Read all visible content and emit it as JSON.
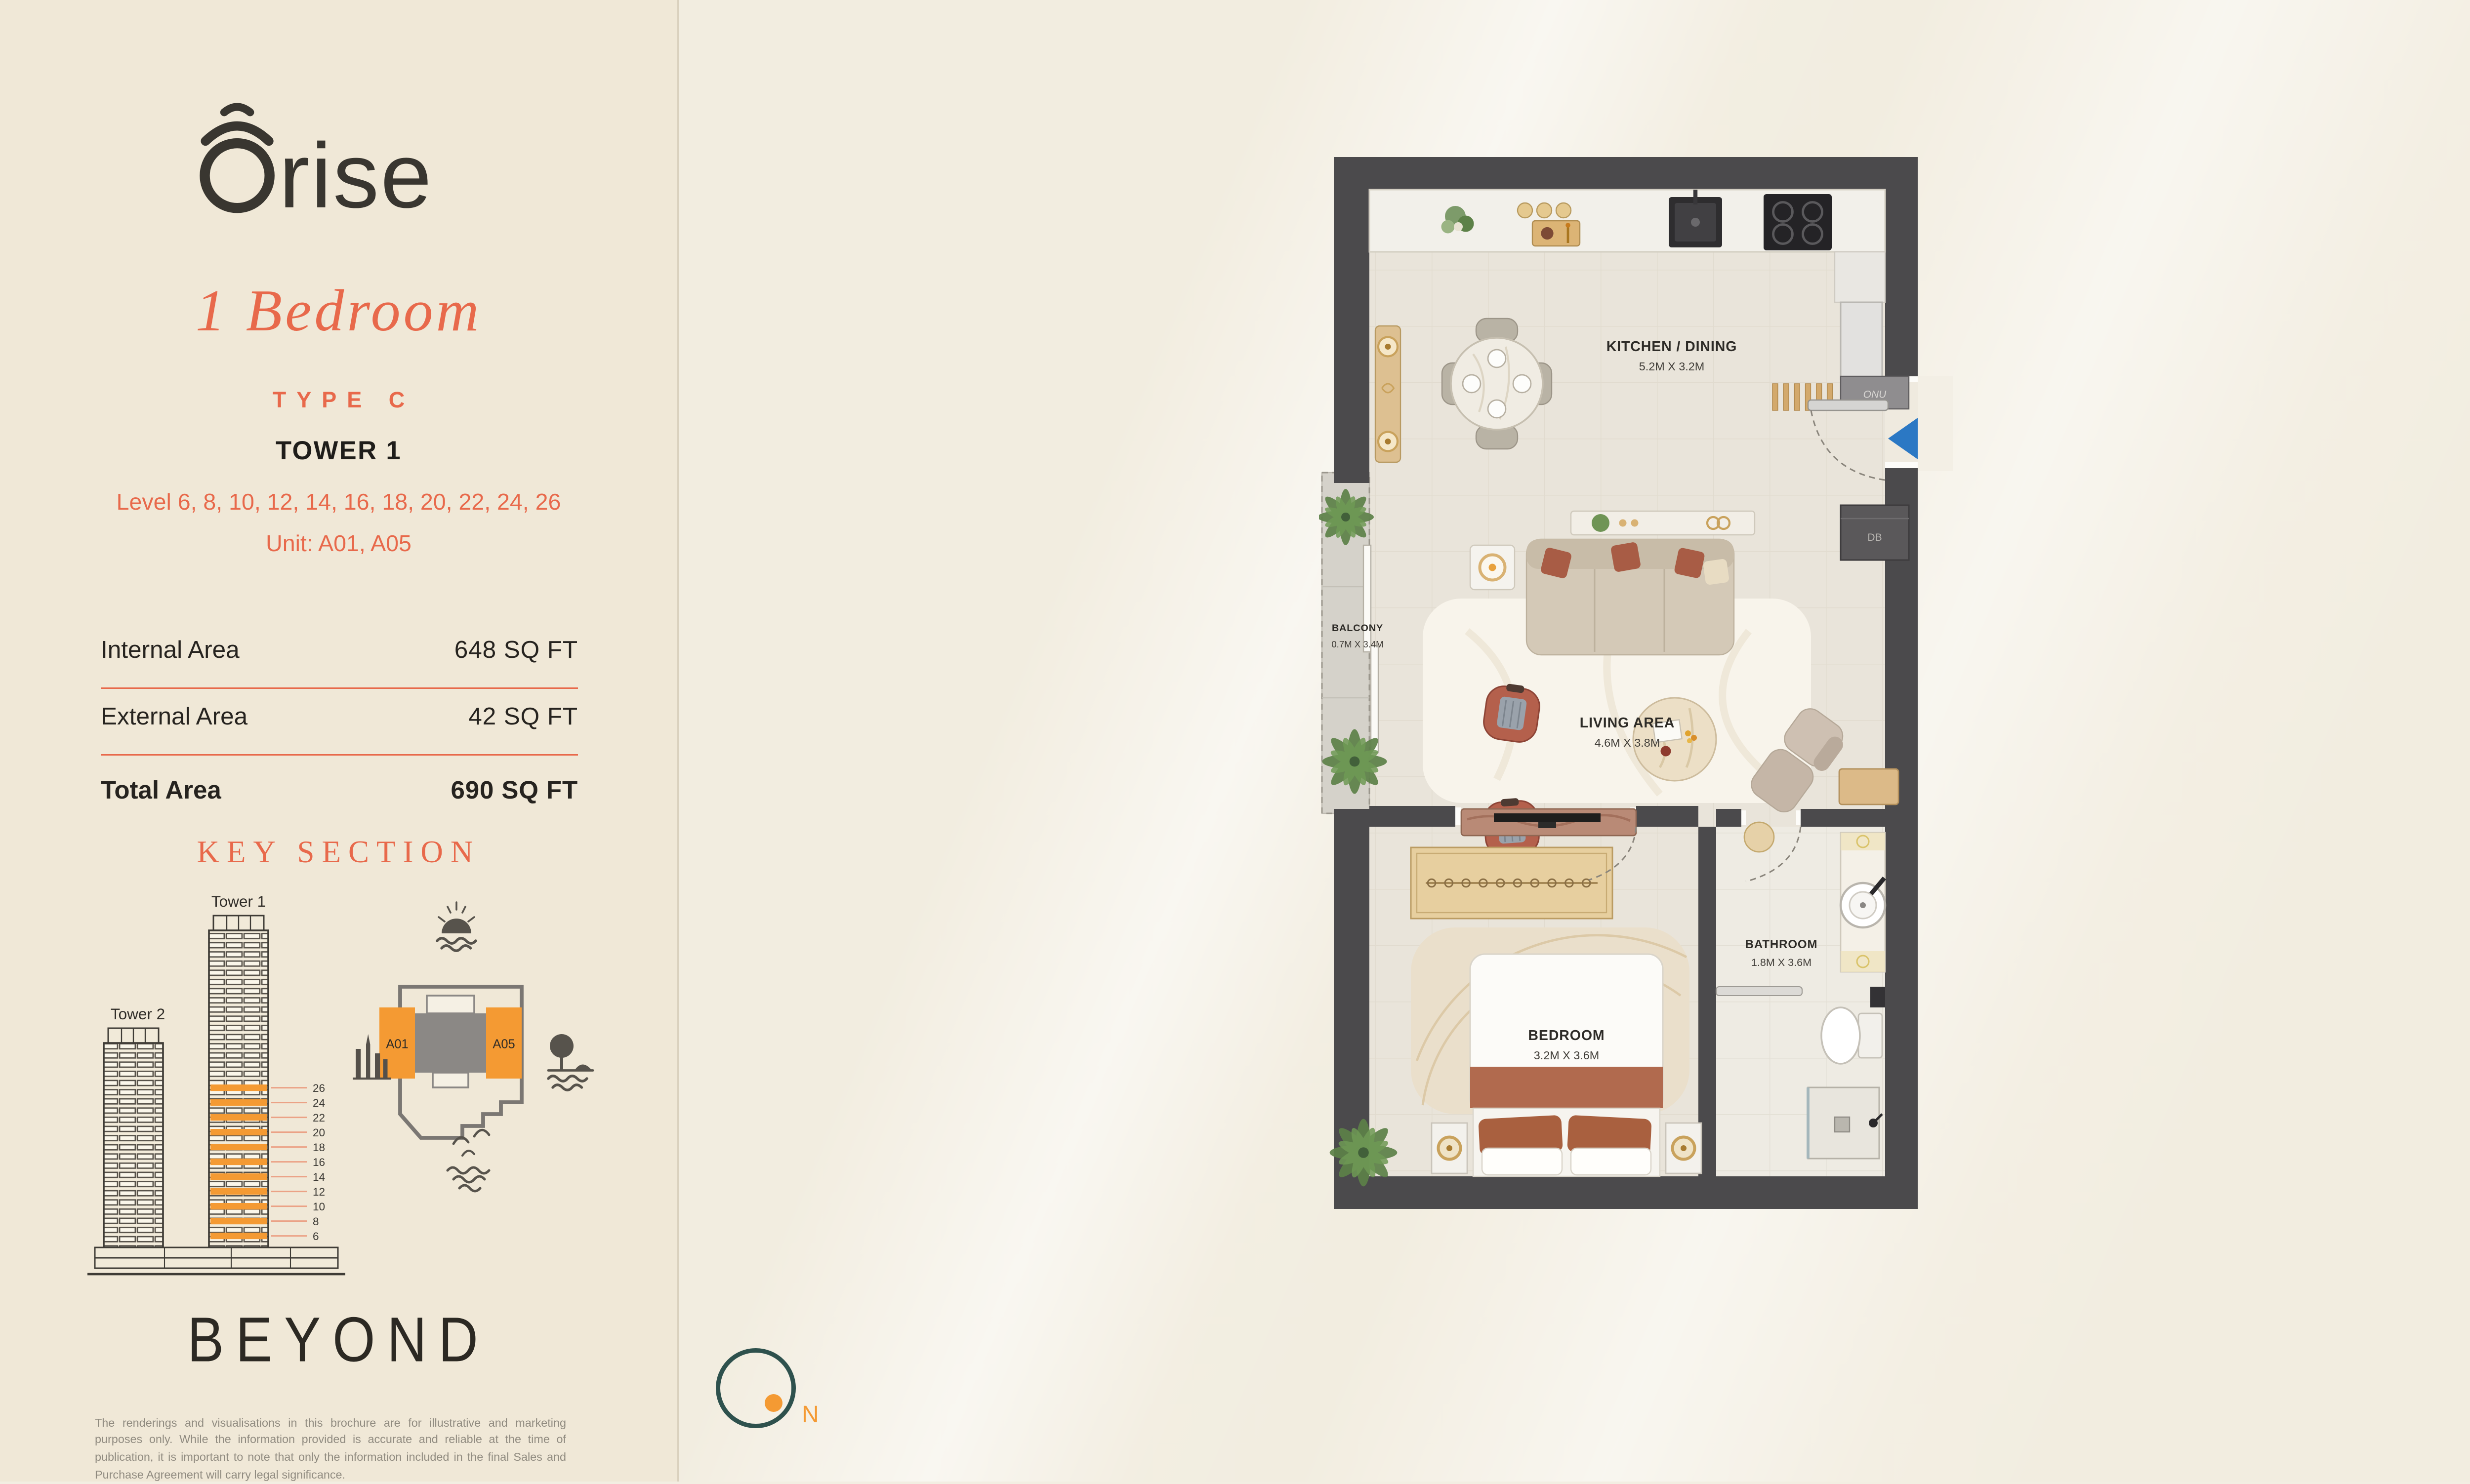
{
  "brand": {
    "logo_suffix": "rise",
    "developer_logo": "BEYOND"
  },
  "header": {
    "unit_title": "1 Bedroom",
    "unit_type": "TYPE C",
    "tower": "TOWER 1",
    "levels": "Level 6, 8, 10, 12, 14, 16, 18, 20, 22, 24, 26",
    "units": "Unit: A01, A05"
  },
  "areas": {
    "rows": [
      {
        "label": "Internal Area",
        "value": "648 SQ FT"
      },
      {
        "label": "External Area",
        "value": "42 SQ FT"
      }
    ],
    "total_label": "Total Area",
    "total_value": "690 SQ FT"
  },
  "key_section": {
    "title": "KEY SECTION",
    "tower1_label": "Tower 1",
    "tower2_label": "Tower 2",
    "levels": [
      "26",
      "24",
      "22",
      "20",
      "18",
      "16",
      "14",
      "12",
      "10",
      "8",
      "6"
    ],
    "unit_left": "A01",
    "unit_right": "A05"
  },
  "floorplan": {
    "rooms": [
      {
        "name": "KITCHEN / DINING",
        "dims": "5.2M X 3.2M"
      },
      {
        "name": "BALCONY",
        "dims": "0.7M X 3.4M"
      },
      {
        "name": "LIVING AREA",
        "dims": "4.6M X 3.8M"
      },
      {
        "name": "BATHROOM",
        "dims": "1.8M X 3.6M"
      },
      {
        "name": "BEDROOM",
        "dims": "3.2M X 3.6M"
      }
    ],
    "tags": {
      "db": "DB",
      "onu": "ONU"
    },
    "north_label": "N"
  },
  "disclaimer": "The renderings and visualisations in this brochure are for illustrative and marketing purposes only. While the information provided is accurate and reliable at the time of publication, it is important to note that only the information included in the final Sales and Purchase Agreement will carry legal significance.",
  "colors": {
    "coral": "#E8694B",
    "orange": "#F49A33",
    "teal": "#2E514D",
    "wall": "#4B4A4C",
    "sidebar": "#F0E8D7",
    "background": "#F2EDE0"
  }
}
